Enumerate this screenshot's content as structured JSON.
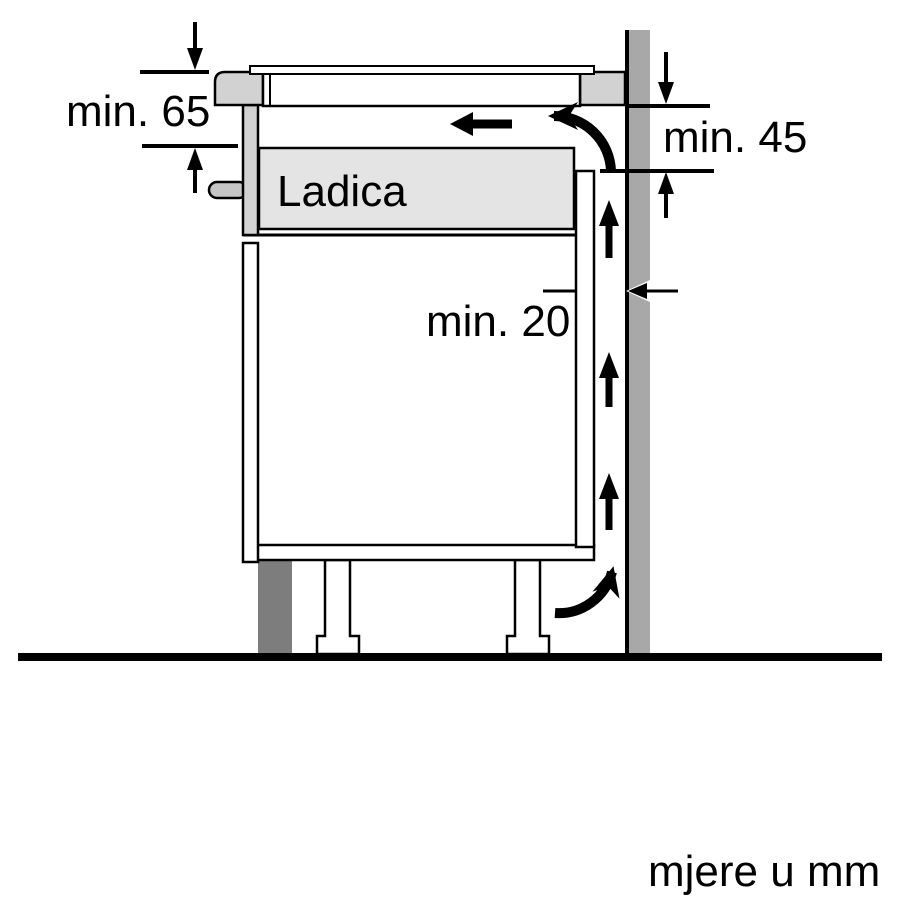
{
  "labels": {
    "clearance_top": "min. 65",
    "clearance_back": "min. 45",
    "wall_gap": "min. 20",
    "drawer": "Ladica",
    "units_note": "mjere u mm"
  },
  "colors": {
    "background": "#ffffff",
    "line": "#000000",
    "arrow": "#000000",
    "wall": "#a8a8a8",
    "worktop": "#d2d2d2",
    "hob_body": "#ffffff",
    "drawer_front": "#d2d2d2",
    "drawer_body": "#e4e4e4",
    "handle": "#c6c6c6",
    "cabinet_panel": "#ffffff",
    "plinth": "#7d7d7d"
  }
}
